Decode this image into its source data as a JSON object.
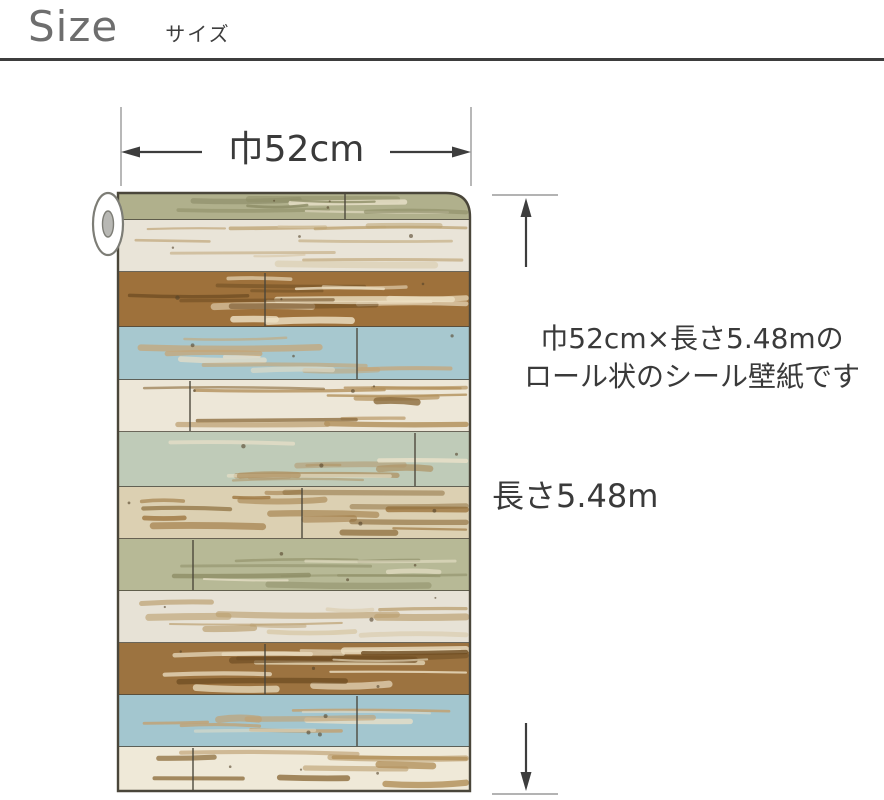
{
  "header": {
    "title": "Size",
    "subtitle": "サイズ"
  },
  "dimensions": {
    "width_label": "巾52cm",
    "height_label": "長さ5.48m"
  },
  "description": {
    "line1": "巾52cm×長さ5.48mの",
    "line2": "ロール状のシール壁紙です"
  },
  "colors": {
    "background": "#ffffff",
    "divider": "#3d3d3d",
    "arrow": "#3d3d3d",
    "guide": "#9a9a9a",
    "text_primary": "#3a3a3a",
    "text_muted": "#6e6e6e",
    "plank_outline": "#4a463a",
    "speck": "#54432a"
  },
  "roll": {
    "tube": {
      "fill": "#ffffff",
      "hole": "#b8b8b4",
      "stroke": "#7d7d76"
    },
    "planks": [
      {
        "name": "sage-green-rolled",
        "base": "#b0b08c",
        "distress": "#8e8e68",
        "accent": "#e9e2ca",
        "h": 27,
        "seams": [
          345
        ],
        "density": 8
      },
      {
        "name": "whitewash",
        "base": "#e9e4d8",
        "distress": "#bba06f",
        "accent": "#d8c9a8",
        "h": 52,
        "seams": [],
        "density": 11
      },
      {
        "name": "brown",
        "base": "#9e713b",
        "distress": "#ecdfc2",
        "accent": "#6e4c22",
        "h": 55,
        "seams": [
          265
        ],
        "density": 15
      },
      {
        "name": "light-blue",
        "base": "#a7c8cf",
        "distress": "#c5a678",
        "accent": "#e4ddc8",
        "h": 53,
        "seams": [
          357
        ],
        "density": 9
      },
      {
        "name": "cream",
        "base": "#ede7d8",
        "distress": "#b3915c",
        "accent": "#8d6d3d",
        "h": 52,
        "seams": [
          190
        ],
        "density": 11
      },
      {
        "name": "pale-teal-green",
        "base": "#bfcbb8",
        "distress": "#b09466",
        "accent": "#e8e0c8",
        "h": 55,
        "seams": [
          415
        ],
        "density": 10
      },
      {
        "name": "scraped-tan",
        "base": "#dcd0b2",
        "distress": "#a07a44",
        "accent": "#8a6a38",
        "h": 52,
        "seams": [
          302
        ],
        "density": 15
      },
      {
        "name": "sage-green",
        "base": "#b7b996",
        "distress": "#8f8f68",
        "accent": "#e9e2ca",
        "h": 52,
        "seams": [
          193
        ],
        "density": 10
      },
      {
        "name": "whitewash-2",
        "base": "#e7e2d6",
        "distress": "#bb9f70",
        "accent": "#d8c9a8",
        "h": 52,
        "seams": [],
        "density": 11
      },
      {
        "name": "brown-2",
        "base": "#9c7340",
        "distress": "#eaddc0",
        "accent": "#6e4c22",
        "h": 52,
        "seams": [
          265
        ],
        "density": 15
      },
      {
        "name": "light-blue-2",
        "base": "#a3c6cf",
        "distress": "#c2a070",
        "accent": "#e4ddc8",
        "h": 52,
        "seams": [
          357
        ],
        "density": 9
      },
      {
        "name": "cream-2",
        "base": "#efe9d8",
        "distress": "#b3915c",
        "accent": "#8d6d3d",
        "h": 44,
        "seams": [
          193
        ],
        "density": 9
      }
    ]
  }
}
